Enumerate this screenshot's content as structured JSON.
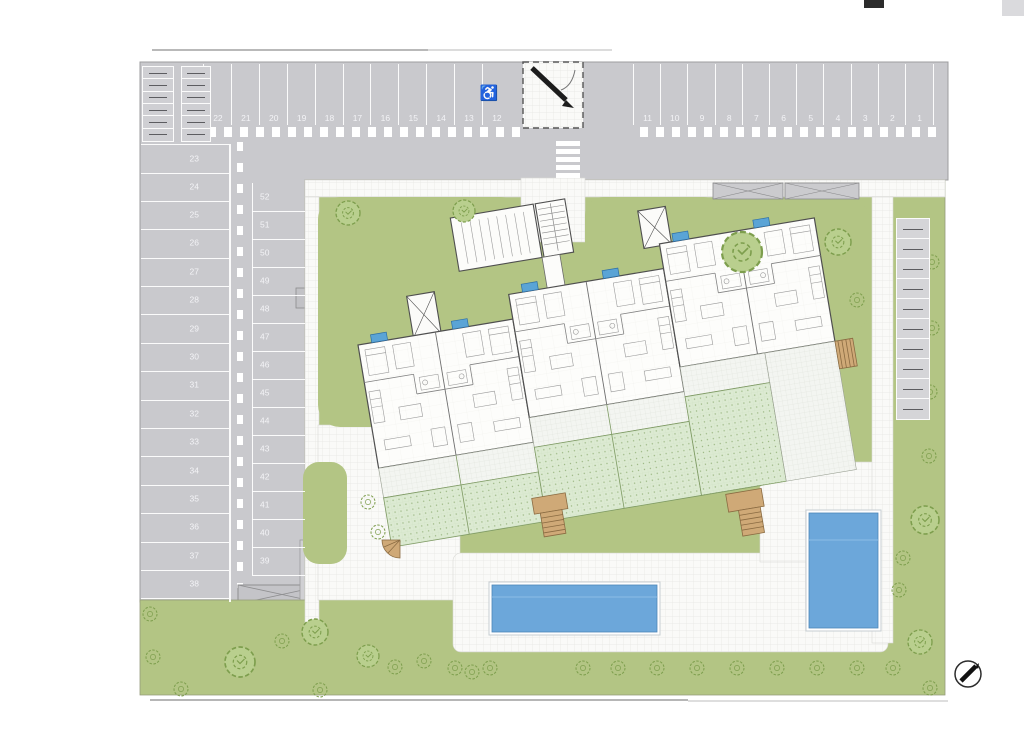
{
  "colors": {
    "asphalt": "#c9c9cd",
    "stall_line": "#ffffff",
    "lawn": "#b3c584",
    "tree_stroke": "#7d9e4d",
    "garden_hatch": "#dcead2",
    "pool_water": "#6ca7da",
    "solar_panel": "#5aa4d6",
    "walk_tile": "#fafaf8",
    "stair_tan": "#cfa977",
    "drawing_line": "#4f4f4f"
  },
  "parking": {
    "top_row": [
      "22",
      "21",
      "20",
      "19",
      "18",
      "17",
      "16",
      "15",
      "14",
      "13",
      "12",
      "11",
      "10",
      "9",
      "8",
      "7",
      "6",
      "5",
      "4",
      "3",
      "2",
      "1"
    ],
    "left_column": [
      "23",
      "24",
      "25",
      "26",
      "27",
      "28",
      "29",
      "30",
      "31",
      "32",
      "33",
      "34",
      "35",
      "36",
      "37",
      "38"
    ],
    "middle_column": [
      "52",
      "51",
      "50",
      "49",
      "48",
      "47",
      "46",
      "45",
      "44",
      "43",
      "42",
      "41",
      "40",
      "39"
    ],
    "accessible_stall": "12",
    "motorbike_stalls_top_left": 12,
    "motorbike_stalls_right": 10
  },
  "icons": {
    "accessible_glyph": "♿",
    "compass": "north-arrow-icon"
  }
}
